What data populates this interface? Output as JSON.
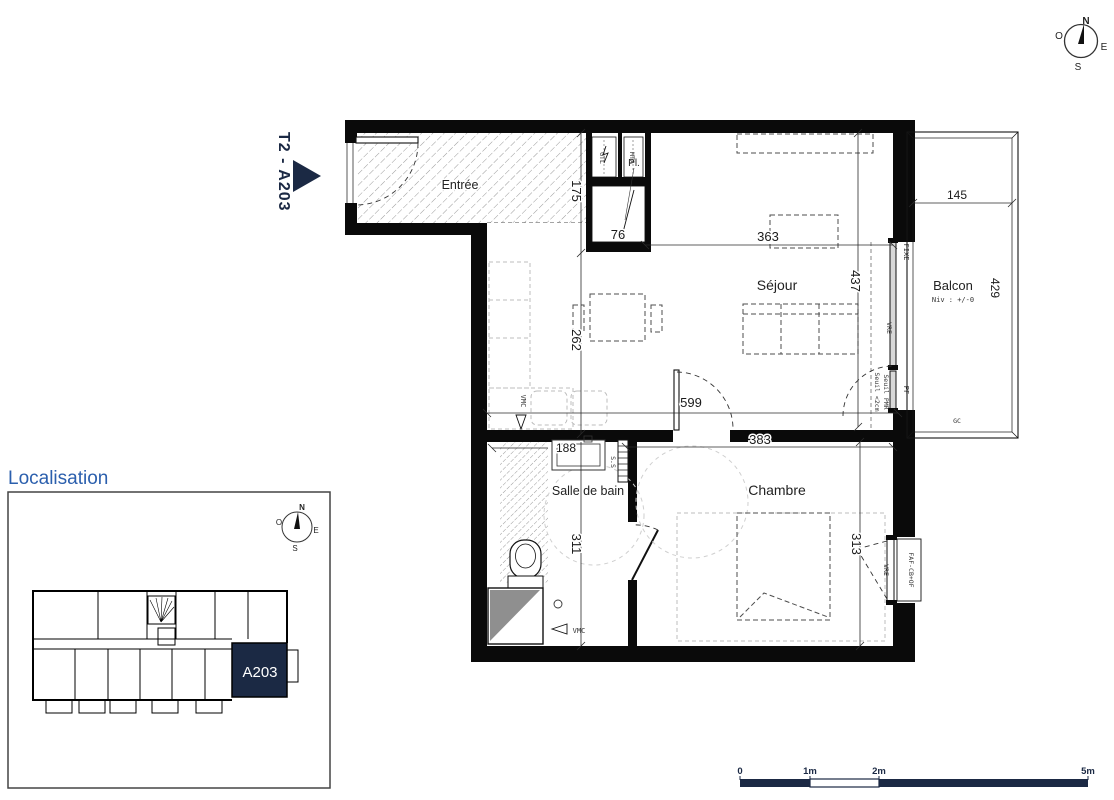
{
  "plan": {
    "marker_label": "T2 - A203",
    "rooms": {
      "entree": "Entrée",
      "sejour": "Séjour",
      "chambre": "Chambre",
      "sdb": "Salle de bain",
      "balcon": "Balcon",
      "balcon_level": "Niv : +/-0",
      "placard": "Pl."
    },
    "dims": {
      "d175": "175",
      "d262": "262",
      "d363": "363",
      "d437": "437",
      "d599": "599",
      "d383": "383",
      "d311": "311",
      "d313": "313",
      "d188": "188",
      "d145": "145",
      "d429": "429",
      "d76": "76"
    },
    "tech": {
      "gtl": "GTL",
      "mta": "MTA",
      "vmc": "VMC",
      "fixe": "FIXE",
      "vre": "VRE",
      "pf": "PF",
      "gc": "GC",
      "ss": "S.S",
      "seuil_2cm": "Seuil <2cm",
      "seuil_pmr": "Seuil PMR",
      "faf": "FAF-CB+OF"
    }
  },
  "compass": {
    "n": "N",
    "s": "S",
    "e": "E",
    "o": "O"
  },
  "localisation": {
    "title": "Localisation",
    "unit_label": "A203"
  },
  "scalebar": {
    "labels": [
      "0",
      "1m",
      "2m",
      "5m"
    ]
  },
  "colors": {
    "navy": "#1b2944",
    "title_blue": "#2b5fad"
  }
}
